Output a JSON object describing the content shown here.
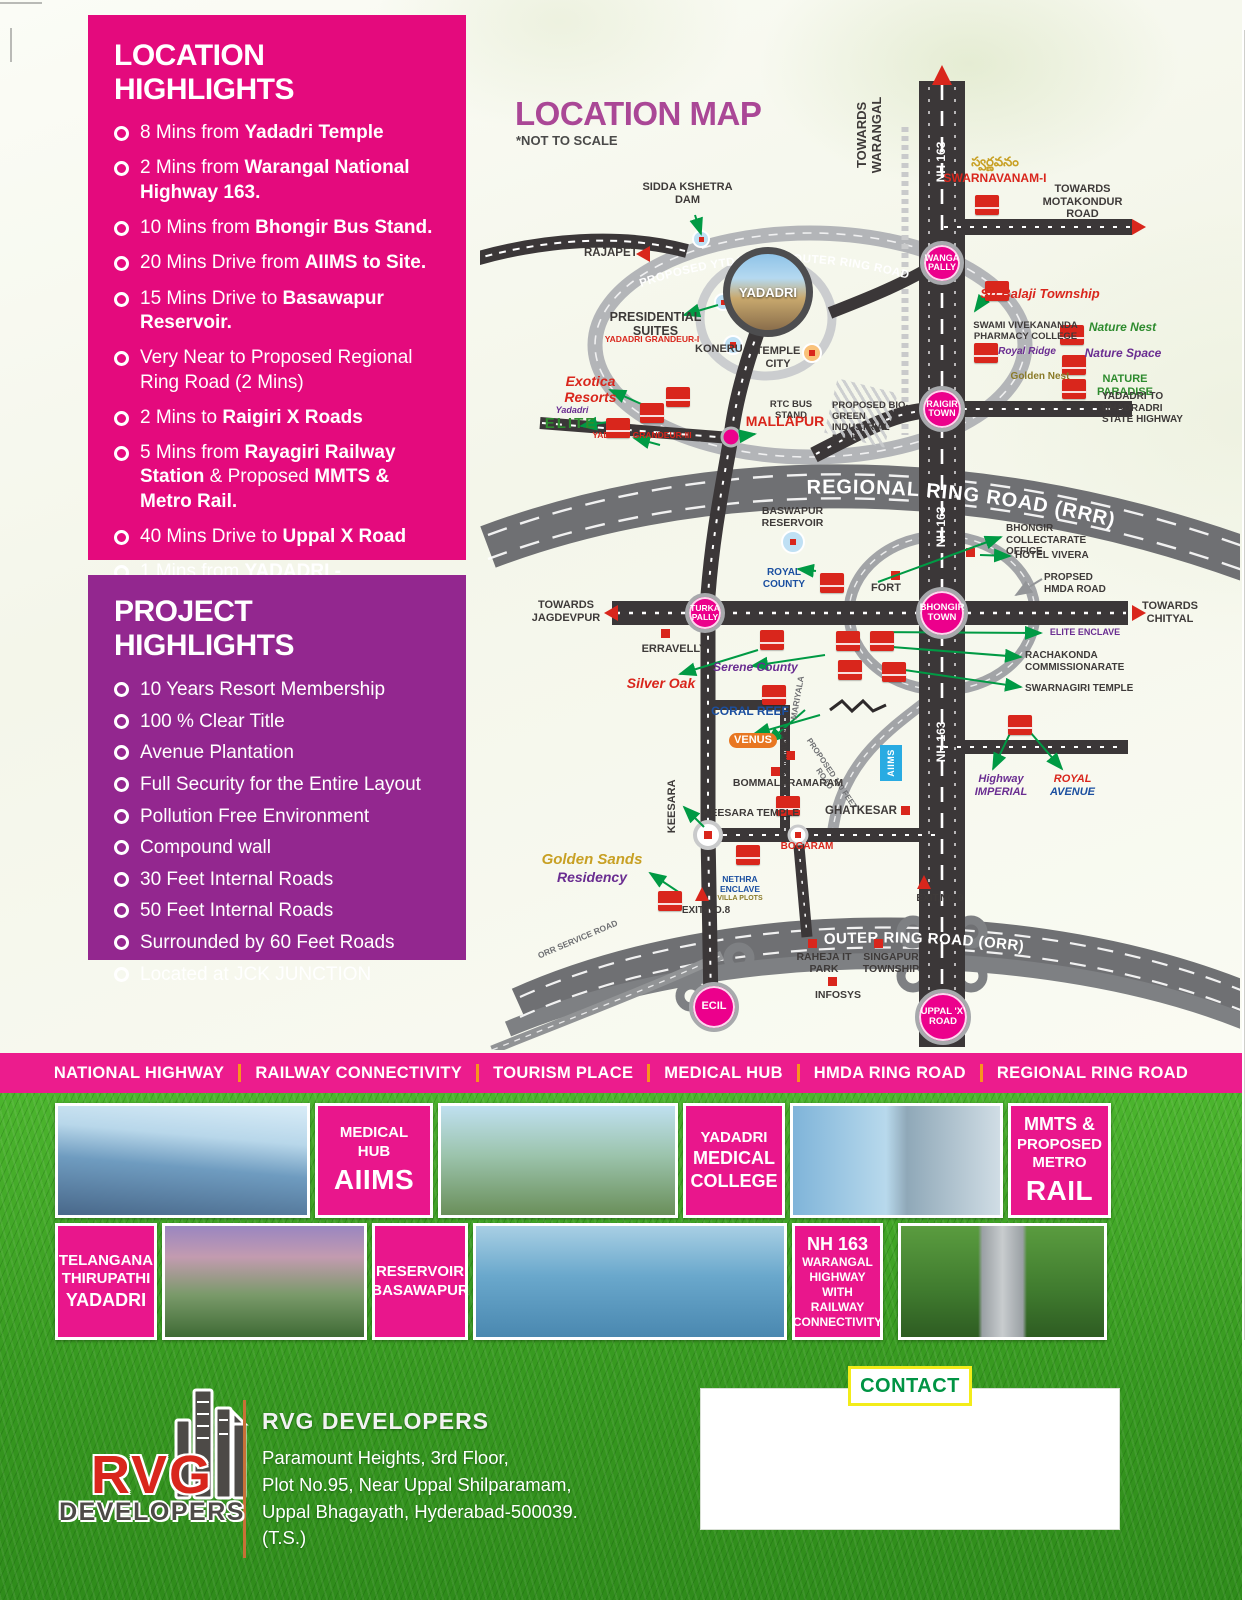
{
  "colors": {
    "panel_pink": "#E40A7D",
    "panel_purple": "#93278F",
    "band_pink": "#EC1C8D",
    "caption_pink": "#E9168C",
    "map_title": "#AA4796",
    "junction_pink": "#EC008C",
    "marker_red": "#D9261C",
    "arrow_green": "#009A44",
    "road_black": "#3B3738",
    "road_gray": "#6F7073",
    "aiims_blue": "#29ABE2",
    "contact_green": "#009444",
    "contact_border_yellow": "#F3EC19",
    "grass_green": "#379920",
    "separator_orange": "#F7941D"
  },
  "location_highlights": {
    "title": "LOCATION HIGHLIGHTS",
    "items": [
      {
        "pre": "8 Mins from ",
        "bold": "Yadadri Temple",
        "post": "",
        "bold2": ""
      },
      {
        "pre": "2 Mins from ",
        "bold": "Warangal National Highway 163.",
        "post": "",
        "bold2": ""
      },
      {
        "pre": "10 Mins from ",
        "bold": "Bhongir Bus Stand.",
        "post": "",
        "bold2": ""
      },
      {
        "pre": "20 Mins Drive from ",
        "bold": "AIIMS to Site.",
        "post": "",
        "bold2": ""
      },
      {
        "pre": "15 Mins Drive to ",
        "bold": "Basawapur Reservoir.",
        "post": "",
        "bold2": ""
      },
      {
        "pre": "Very Near to Proposed Regional Ring Road (2 Mins)",
        "bold": "",
        "post": "",
        "bold2": ""
      },
      {
        "pre": "2 Mins to ",
        "bold": "Raigiri X Roads",
        "post": "",
        "bold2": ""
      },
      {
        "pre": "5 Mins from ",
        "bold": "Rayagiri Railway Station",
        "post": " & Proposed ",
        "bold2": "MMTS & Metro Rail."
      },
      {
        "pre": "40 Mins Drive to ",
        "bold": "Uppal X Road",
        "post": "",
        "bold2": ""
      },
      {
        "pre": "1 Mins from ",
        "bold": "YADADRI - BHADRADRI NATIONAL HIGHWAY",
        "post": "",
        "bold2": ""
      }
    ]
  },
  "project_highlights": {
    "title": "PROJECT HIGHLIGHTS",
    "items": [
      "10 Years Resort Membership",
      "100 % Clear Title",
      "Avenue Plantation",
      "Full Security for the Entire Layout",
      "Pollution Free Environment",
      "Compound wall",
      "30 Feet Internal Roads",
      "50 Feet Internal Roads",
      "Surrounded by 60 Feet Roads",
      "Located at JCK JUNCTION"
    ]
  },
  "map": {
    "title": "LOCATION MAP",
    "note": "*NOT TO SCALE",
    "roads": {
      "nh163": "NH 163",
      "rrr": "REGIONAL RING ROAD (RRR)",
      "orr": "OUTER RING ROAD (ORR)",
      "ytda": "PROPOSED YTDA 165 FT. OUTER RING ROAD",
      "orr_service": "ORR SERVICE ROAD",
      "proposed_150": "PROPOSED 150 FEET ROAD",
      "chikatimamidi": "CHIKATIMAMIDI",
      "mariyala": "MARIYALA"
    },
    "junctions": {
      "wanga": "WANGA PALLY",
      "raigir": "RAIGIR TOWN",
      "turka": "TURKA PALLY",
      "bhongir": "BHONGIR TOWN",
      "ecil": "ECIL",
      "uppal": "UPPAL 'X' ROAD",
      "yadadri": "YADADRI"
    },
    "labels": {
      "towards_warangal": "TOWARDS WARANGAL",
      "swarnavanam_telugu": "స్వర్ణవనం",
      "swarnavanam": "SWARNAVANAM-I",
      "towards_motakondur": "TOWARDS MOTAKONDUR ROAD",
      "sri_balaji": "Sri Balaji Township",
      "swami_vivekananda": "SWAMI VIVEKANANDA PHARMACY COLLEGE",
      "royal_ridge": "Royal Ridge",
      "nature_nest": "Nature Nest",
      "nature_space": "Nature Space",
      "golden_nest": "Golden Nest",
      "nature_paradise": "NATURE PARADISE",
      "yadadri_bhadradri_hwy": "YADADRI TO BHADRADRI STATE HIGHWAY",
      "proposed_biogreen": "PROPOSED BIO-GREEN INDUSTRIAL PARK",
      "sidda_kshetra": "SIDDA KSHETRA DAM",
      "rajapet": "RAJAPET",
      "presidential_suites": "PRESIDENTIAL SUITES",
      "koneru": "KONERU",
      "temple_city": "TEMPLE CITY",
      "exotica": "Exotica Resorts",
      "grandeur1": "YADADRI GRANDEUR-I",
      "elite_brand": "Yadadri",
      "elite_name": "ELITE",
      "grandeur3": "YADADRI GRANDEUR-III",
      "rtc_bus_stand": "RTC BUS STAND",
      "mallapur": "MALLAPUR",
      "baswapur_reservoir": "BASWAPUR RESERVOIR",
      "royal_county": "ROYAL COUNTY",
      "towards_jagdevpur": "TOWARDS JAGDEVPUR",
      "erravelly": "ERRAVELLY",
      "fort": "FORT",
      "bhongir_collectarate": "BHONGIR COLLECTARATE OFFICE",
      "hotel_vivera": "HOTEL VIVERA",
      "propsed_hmda": "PROPSED HMDA ROAD",
      "towards_chityal": "TOWARDS CHITYAL",
      "elite_enclave": "ELITE ENCLAVE",
      "rachakonda": "RACHAKONDA COMMISSIONARATE",
      "swarnagiri": "SWARNAGIRI TEMPLE",
      "silver_oak": "Silver Oak",
      "serene_county": "Serene County",
      "coral_reef": "CORAL REEF",
      "venus": "VENUS",
      "bommalaramaram": "BOMMALARAMARAM",
      "aiims": "AIIMS",
      "highway_imperial": "Highway IMPERIAL",
      "royal_avenue_1": "ROYAL",
      "royal_avenue_2": "AVENUE",
      "keesara": "KEESARA",
      "keesara_temple": "KEESARA TEMPLE",
      "ghatkesar": "GHATKESAR",
      "bogaram": "BOGARAM",
      "golden_sands_1": "Golden Sands",
      "golden_sands_2": "Residency",
      "nethra_enclave": "NETHRA ENCLAVE",
      "nethra_sub": "VILLA PLOTS",
      "exit8": "EXIT-NO.8",
      "exit9": "EXIT.NO.9",
      "raheja": "RAHEJA IT PARK",
      "singapur": "SINGAPUR TOWNSHIP",
      "infosys": "INFOSYS"
    }
  },
  "band": {
    "items": [
      "NATIONAL HIGHWAY",
      "RAILWAY CONNECTIVITY",
      "TOURISM PLACE",
      "MEDICAL HUB",
      "HMDA RING ROAD",
      "REGIONAL RING ROAD"
    ]
  },
  "gallery": {
    "medical_hub": [
      "MEDICAL",
      "HUB",
      "AIIMS"
    ],
    "yadadri_medical": [
      "YADADRI",
      "MEDICAL",
      "COLLEGE"
    ],
    "mmts": [
      "MMTS &",
      "PROPOSED",
      "METRO",
      "RAIL"
    ],
    "telangana": [
      "TELANGANA",
      "THIRUPATHI",
      "YADADRI"
    ],
    "reservoir": [
      "RESERVOIR",
      "BASAWAPUR"
    ],
    "nh163": [
      "NH 163",
      "WARANGAL",
      "HIGHWAY WITH",
      "RAILWAY",
      "CONNECTIVITY"
    ]
  },
  "footer": {
    "logo_rvg": "RVG",
    "logo_developers": "DEVELOPERS",
    "company": "RVG DEVELOPERS",
    "address": [
      "Paramount Heights, 3rd Floor,",
      "Plot No.95, Near Uppal Shilparamam,",
      "Uppal Bhagayath, Hyderabad-500039. (T.S.)"
    ],
    "contact_label": "CONTACT"
  }
}
